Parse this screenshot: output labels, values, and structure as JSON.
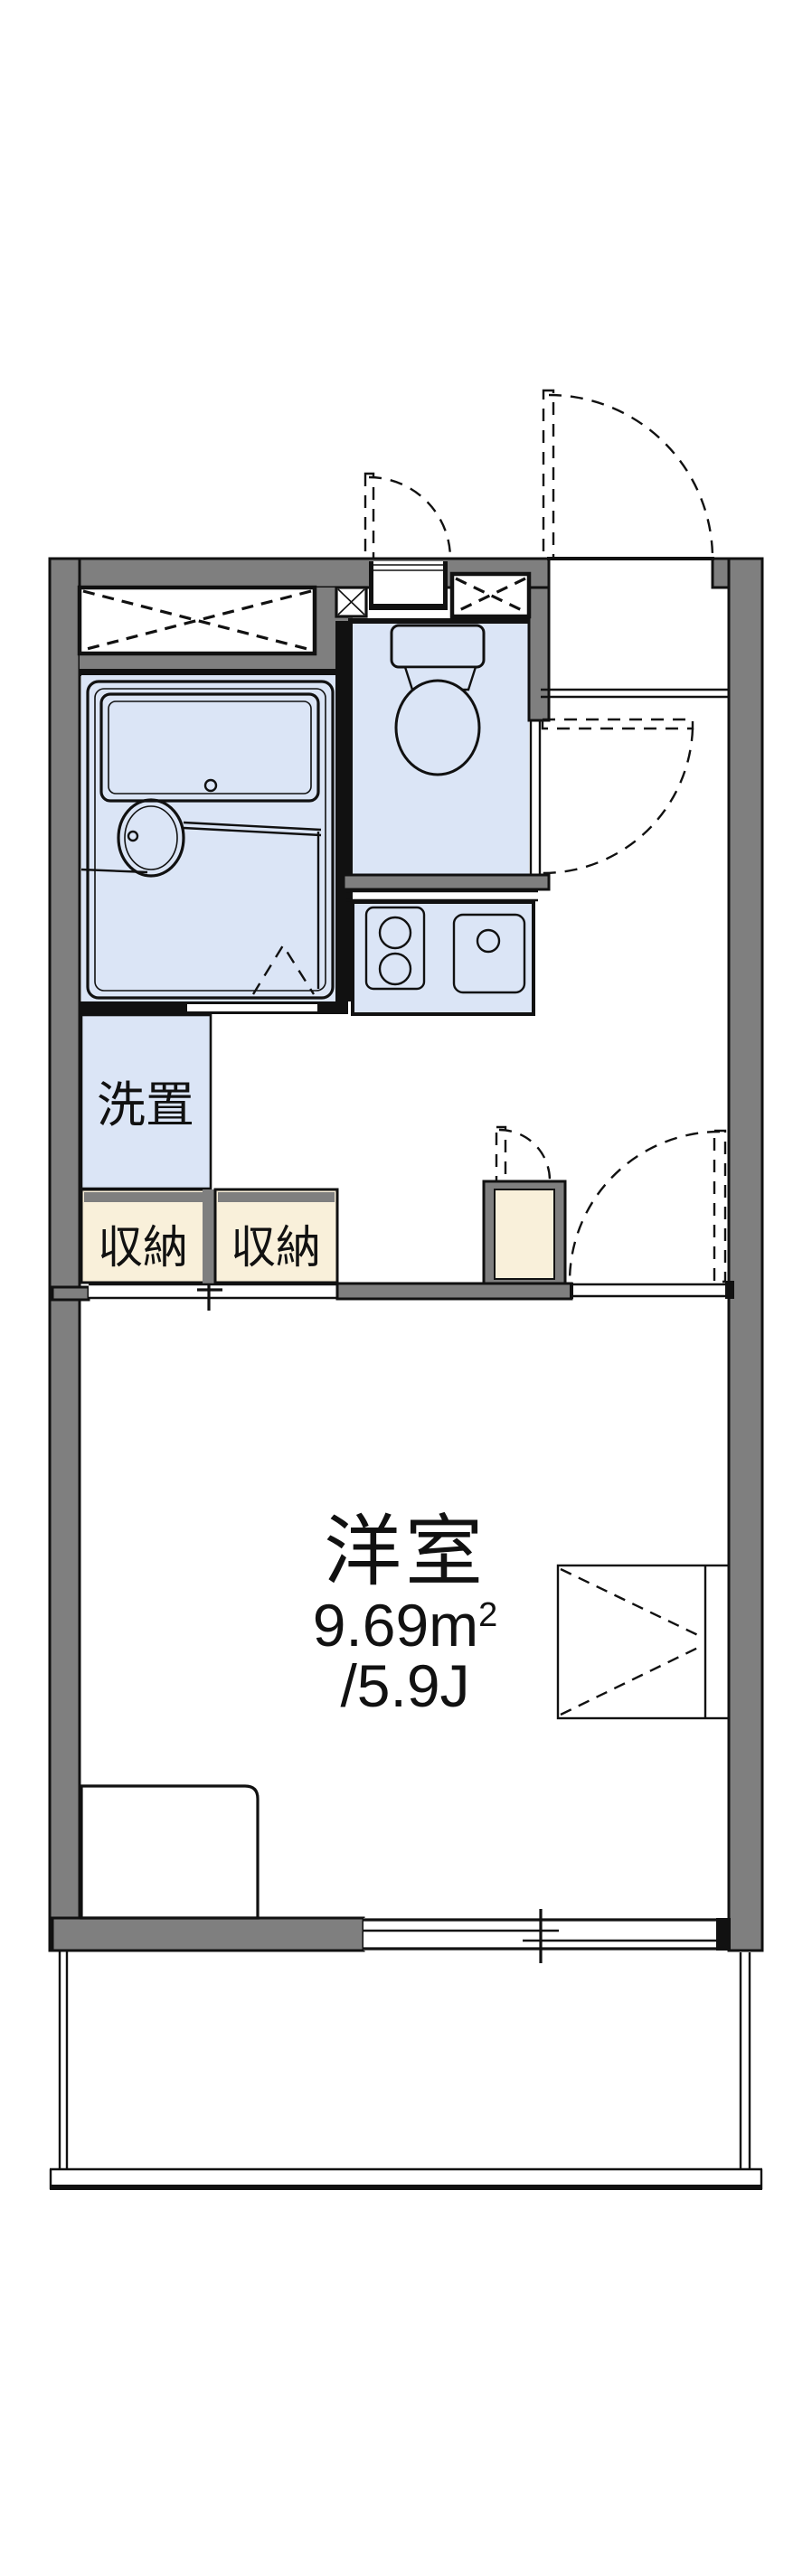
{
  "plan_title": "1K apartment floor plan",
  "labels": {
    "room_name": "洋室",
    "area_m2_base": "9.69m",
    "area_m2_sup": "2",
    "area_jo": "/5.9J",
    "washer": "洗置",
    "storage": "収納"
  },
  "rooms": {
    "western_room": {
      "name": "洋室",
      "area_m2": "9.69m²",
      "area_tatami": "/5.9J"
    },
    "washer_space": {
      "name": "洗置"
    },
    "storage_left": {
      "name": "収納"
    },
    "storage_right": {
      "name": "収納"
    }
  },
  "colors": {
    "bg": "#ffffff",
    "wall_gray": "#7f7f7f",
    "line_black": "#111111",
    "fixture_blue": "#dbe5f6",
    "storage_cream": "#f9f0da"
  }
}
